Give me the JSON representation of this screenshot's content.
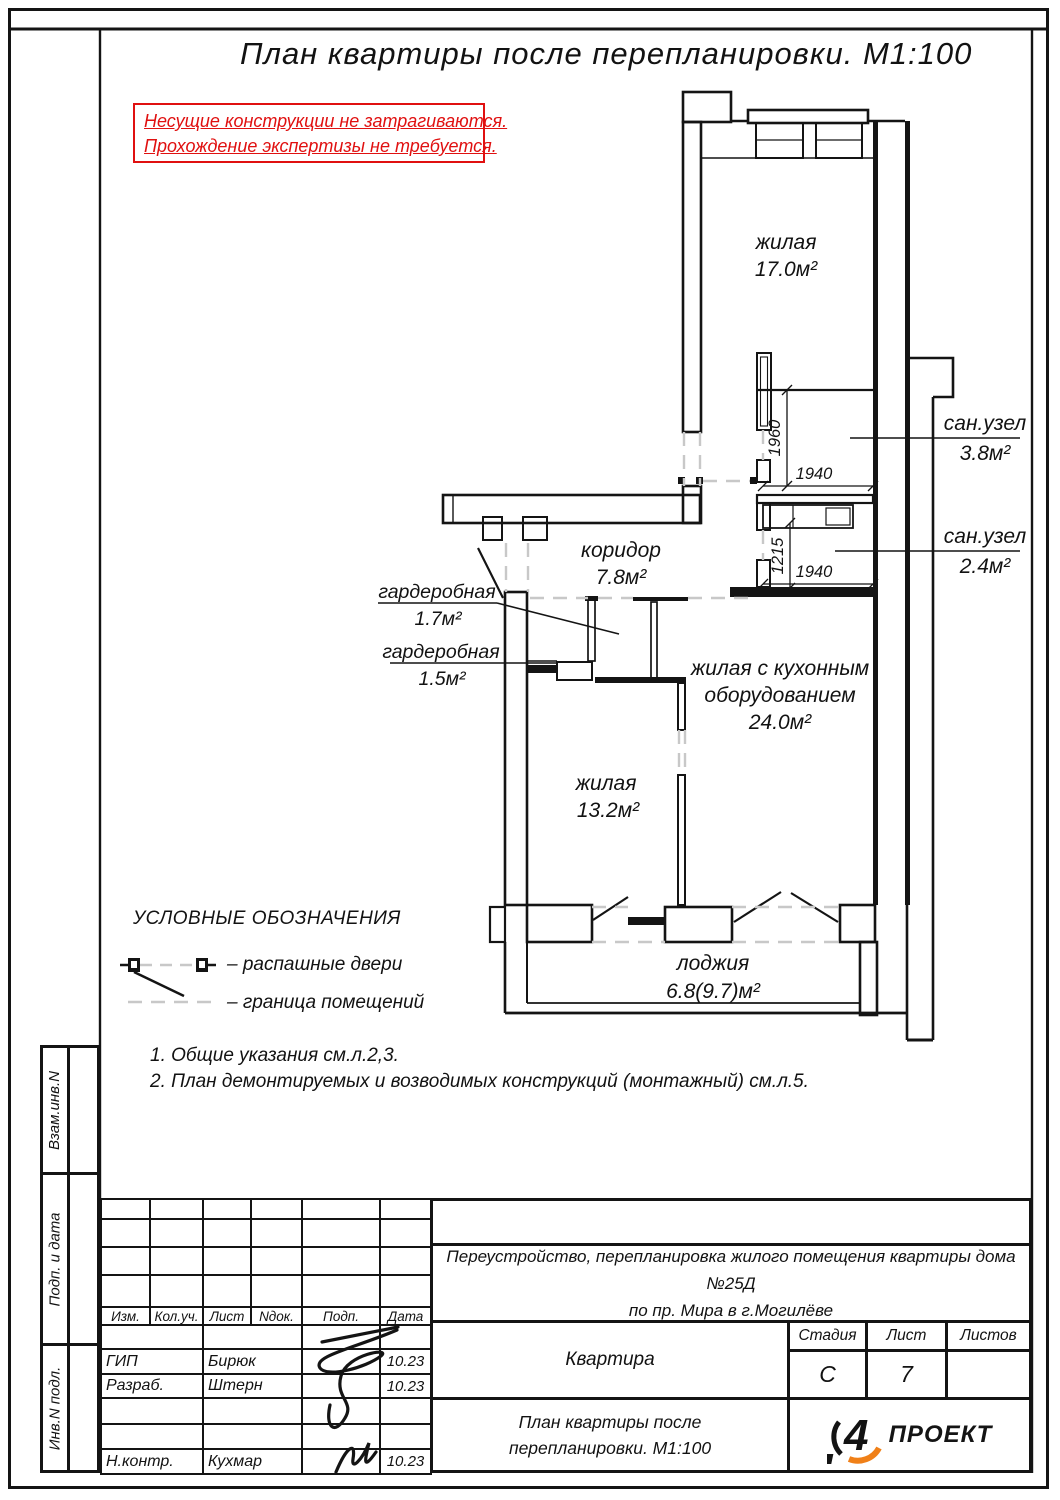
{
  "sheet": {
    "title": "План квартиры после перепланировки. М1:100",
    "warning_line1": "Несущие конструкции не затрагиваются.",
    "warning_line2": "Прохождение экспертизы не требуется."
  },
  "plan": {
    "room_zhilaya17": {
      "name": "жилая",
      "area": "17.0м²"
    },
    "room_san38": {
      "name": "сан.узел",
      "area": "3.8м²"
    },
    "room_san24": {
      "name": "сан.узел",
      "area": "2.4м²"
    },
    "room_koridor": {
      "name": "коридор",
      "area": "7.8м²"
    },
    "room_gard17": {
      "name": "гардеробная",
      "area": "1.7м²"
    },
    "room_gard15": {
      "name": "гардеробная",
      "area": "1.5м²"
    },
    "room_kitchen": {
      "name1": "жилая с кухонным",
      "name2": "оборудованием",
      "area": "24.0м²"
    },
    "room_zhilaya13": {
      "name": "жилая",
      "area": "13.2м²"
    },
    "room_loggia": {
      "name": "лоджия",
      "area": "6.8(9.7)м²"
    },
    "dims": {
      "v1": "1960",
      "h1": "1940",
      "v2": "1215",
      "h2": "1940"
    }
  },
  "legend": {
    "title": "УСЛОВНЫЕ ОБОЗНАЧЕНИЯ",
    "item_doors": "– распашные двери",
    "item_boundary": "– граница помещений"
  },
  "notes": {
    "n1": "1. Общие указания см.л.2,3.",
    "n2": "2. План демонтируемых и возводимых конструкций (монтажный) см.л.5."
  },
  "titleblock": {
    "columns": {
      "c1": "Изм.",
      "c2": "Кол.уч.",
      "c3": "Лист",
      "c4": "Nдок.",
      "c5": "Подп.",
      "c6": "Дата"
    },
    "rows": {
      "gip": {
        "role": "ГИП",
        "name": "Бирюк",
        "date": "10.23"
      },
      "razrab": {
        "role": "Разраб.",
        "name": "Штерн",
        "date": "10.23"
      },
      "nkontr": {
        "role": "Н.контр.",
        "name": "Кухмар",
        "date": "10.23"
      }
    },
    "project_line1": "Переустройство, перепланировка жилого помещения квартиры дома №25Д",
    "project_line2": "по пр. Мира в г.Могилёве",
    "object": "Квартира",
    "stage_label": "Стадия",
    "sheet_label": "Лист",
    "sheets_label": "Листов",
    "stage": "С",
    "sheet_no": "7",
    "sheets_total": "",
    "doc_title1": "План квартиры после",
    "doc_title2": "перепланировки. М1:100",
    "logo_text": "ПРОЕКТ",
    "logo_glyph": "4"
  },
  "sidebar": {
    "cell1": "Взам.инв.N",
    "cell2": "Подп. и дата",
    "cell3": "Инв.N подл."
  },
  "colors": {
    "warning_red": "#e01010",
    "logo_orange": "#f08018",
    "boundary_gray": "#c8c8c8",
    "line_black": "#141414"
  }
}
